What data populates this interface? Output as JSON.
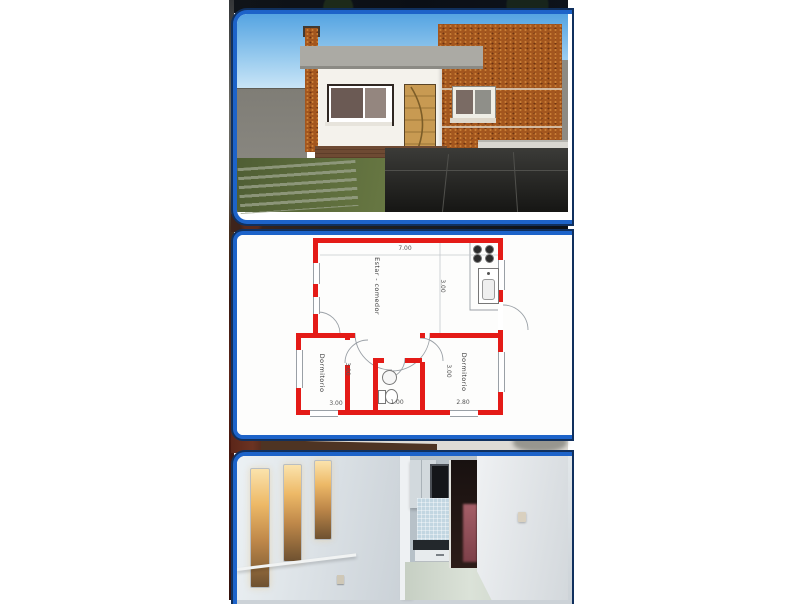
{
  "collage": {
    "accent_blue": "#1d63c9",
    "panels": [
      {
        "id": "exterior-render",
        "alt": "3D exterior render of a single-story house with white facade, brick columns and wooden door"
      },
      {
        "id": "floor-plan",
        "alt": "Floor plan with red walls: living-dining room, kitchen, two bedrooms and bathroom"
      },
      {
        "id": "interior-photo",
        "alt": "Interior view with three lit wall niches, kitchen pass-through and dark doorway"
      }
    ]
  },
  "floor_plan": {
    "wall_color": "#e41b17",
    "rooms": {
      "living": {
        "label": "Estar - comedor"
      },
      "bedroom_left": {
        "label": "Dormitorio"
      },
      "bedroom_right": {
        "label": "Dormitorio"
      }
    },
    "dimensions": {
      "living_width": "7.00",
      "living_depth": "3.00",
      "bedroom_left_depth": "3.00",
      "bedroom_left_width": "3.00",
      "bath_width": "1.00",
      "bedroom_right_width": "2.80",
      "bedroom_right_depth": "3.00"
    }
  }
}
